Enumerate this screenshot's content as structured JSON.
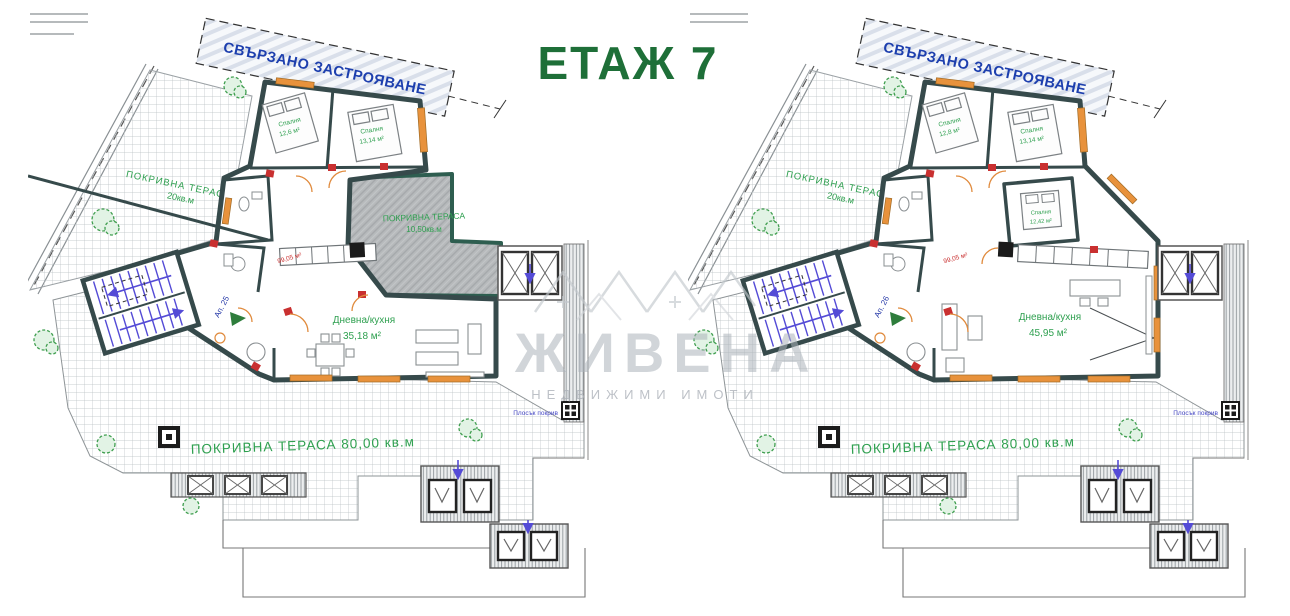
{
  "title": {
    "text": "ЕТАЖ 7"
  },
  "watermark": {
    "name": "ЖИВЕНА",
    "tagline": "НЕДВИЖИМИ ИМОТИ"
  },
  "colors": {
    "wall": "#364a4b",
    "terrace_border": "#2e5e50",
    "green_label": "#2fa050",
    "banner_blue": "#1d3fae",
    "stairs_blue": "#544bd6",
    "red_accent": "#c93030",
    "window_orange": "#e8923c",
    "title_green": "#1e6f38",
    "watermark_grey": "#ccd0d4"
  },
  "plans": [
    {
      "name": "plan-left",
      "banner": "СВЪРЗАНО ЗАСТРОЯВАНЕ",
      "apartment": "Ап. 25",
      "area_total": "99,05 м²",
      "bedroom1": {
        "label": "Спалня",
        "area": "12,6 м²"
      },
      "bedroom2": {
        "label": "Спалня",
        "area": "13,14 м²"
      },
      "living": {
        "label": "Дневна/кухня",
        "area": "35,18 м²"
      },
      "terrace_upper": {
        "label": "ПОКРИВНА ТЕРАСА",
        "area": "20кв.м"
      },
      "terrace_covered": {
        "label": "ПОКРИВНА ТЕРАСА",
        "area": "10,50кв.м"
      },
      "terrace_main": "ПОКРИВНА ТЕРАСА 80,00 кв.м",
      "flat_roof": "Плосък покрив"
    },
    {
      "name": "plan-right",
      "banner": "СВЪРЗАНО ЗАСТРОЯВАНЕ",
      "apartment": "Ап. 26",
      "area_total": "99,05 м²",
      "bedroom1": {
        "label": "Спалня",
        "area": "12,8 м²"
      },
      "bedroom2": {
        "label": "Спалня",
        "area": "13,14 м²"
      },
      "bedroom3": {
        "label": "Спалня",
        "area": "12,42 м²"
      },
      "living": {
        "label": "Дневна/кухня",
        "area": "45,95 м²"
      },
      "terrace_upper": {
        "label": "ПОКРИВНА ТЕРАСА",
        "area": "20кв.м"
      },
      "terrace_main": "ПОКРИВНА ТЕРАСА 80,00 кв.м",
      "flat_roof": "Плосък покрив"
    }
  ]
}
